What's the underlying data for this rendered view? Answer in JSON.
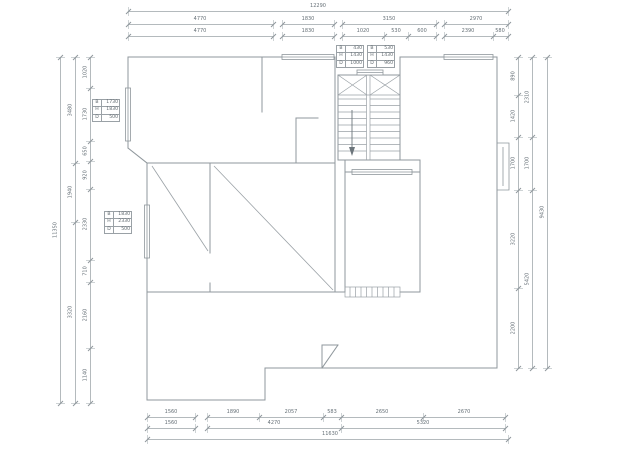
{
  "style": {
    "background": "#ffffff",
    "wall_color": "#8f979c",
    "thin_line_color": "#9aa1a6",
    "dim_line_color": "#b4babd",
    "dim_text_color": "#667077"
  },
  "dim_chains": [
    {
      "id": "top-total",
      "dir": "h",
      "pos": 11,
      "groups": [
        {
          "a": 128,
          "b": 508,
          "ticks": [
            128,
            508
          ],
          "labels": [
            {
              "v": "12290",
              "p": 318
            }
          ]
        }
      ]
    },
    {
      "id": "top-row2",
      "dir": "h",
      "pos": 24,
      "groups": [
        {
          "a": 128,
          "b": 273,
          "ticks": [
            128,
            273
          ],
          "labels": [
            {
              "v": "4770",
              "p": 200
            }
          ]
        },
        {
          "a": 282,
          "b": 334,
          "ticks": [
            282,
            334
          ],
          "labels": [
            {
              "v": "1830",
              "p": 308
            }
          ]
        },
        {
          "a": 342,
          "b": 436,
          "ticks": [
            342,
            436
          ],
          "labels": [
            {
              "v": "3150",
              "p": 389
            }
          ]
        },
        {
          "a": 444,
          "b": 508,
          "ticks": [
            444,
            508
          ],
          "labels": [
            {
              "v": "2970",
              "p": 476
            }
          ]
        }
      ]
    },
    {
      "id": "top-row3",
      "dir": "h",
      "pos": 36,
      "groups": [
        {
          "a": 128,
          "b": 273,
          "ticks": [
            128,
            273
          ],
          "labels": [
            {
              "v": "4770",
              "p": 200
            }
          ]
        },
        {
          "a": 282,
          "b": 334,
          "ticks": [
            282,
            334
          ],
          "labels": [
            {
              "v": "1830",
              "p": 308
            }
          ]
        },
        {
          "a": 342,
          "b": 436,
          "ticks": [
            342,
            384,
            408,
            436
          ],
          "labels": [
            {
              "v": "1020",
              "p": 363
            },
            {
              "v": "530",
              "p": 396
            },
            {
              "v": "600",
              "p": 422
            }
          ]
        },
        {
          "a": 444,
          "b": 508,
          "ticks": [
            444,
            493,
            508
          ],
          "labels": [
            {
              "v": "2390",
              "p": 468
            },
            {
              "v": "580",
              "p": 500
            }
          ]
        }
      ]
    },
    {
      "id": "left-total",
      "dir": "v",
      "pos": 60,
      "groups": [
        {
          "a": 57,
          "b": 403,
          "ticks": [
            57,
            403
          ],
          "labels": [
            {
              "v": "11350",
              "p": 230
            }
          ]
        }
      ]
    },
    {
      "id": "left-mid",
      "dir": "v",
      "pos": 75,
      "groups": [
        {
          "a": 57,
          "b": 403,
          "ticks": [
            57,
            163,
            222,
            403
          ],
          "labels": [
            {
              "v": "3480",
              "p": 110
            },
            {
              "v": "1940",
              "p": 192
            },
            {
              "v": "3320",
              "p": 312
            }
          ]
        }
      ]
    },
    {
      "id": "left-inner",
      "dir": "v",
      "pos": 90,
      "groups": [
        {
          "a": 57,
          "b": 403,
          "ticks": [
            57,
            88,
            141,
            161,
            189,
            260,
            282,
            348,
            403
          ],
          "labels": [
            {
              "v": "1020",
              "p": 72
            },
            {
              "v": "1730",
              "p": 114
            },
            {
              "v": "650",
              "p": 151
            },
            {
              "v": "920",
              "p": 175
            },
            {
              "v": "2330",
              "p": 224
            },
            {
              "v": "710",
              "p": 271
            },
            {
              "v": "2160",
              "p": 315
            },
            {
              "v": "1140",
              "p": 375
            }
          ]
        }
      ]
    },
    {
      "id": "right-inner",
      "dir": "v",
      "pos": 518,
      "groups": [
        {
          "a": 57,
          "b": 368,
          "ticks": [
            57,
            95,
            137,
            190,
            288,
            368
          ],
          "labels": [
            {
              "v": "890",
              "p": 76
            },
            {
              "v": "1420",
              "p": 116
            },
            {
              "v": "1700",
              "p": 163
            },
            {
              "v": "3220",
              "p": 239
            },
            {
              "v": "2200",
              "p": 328
            }
          ]
        }
      ]
    },
    {
      "id": "right-mid",
      "dir": "v",
      "pos": 532,
      "groups": [
        {
          "a": 57,
          "b": 368,
          "ticks": [
            57,
            137,
            190,
            368
          ],
          "labels": [
            {
              "v": "2310",
              "p": 97
            },
            {
              "v": "1700",
              "p": 163
            },
            {
              "v": "5420",
              "p": 279
            }
          ]
        }
      ]
    },
    {
      "id": "right-outer",
      "dir": "v",
      "pos": 547,
      "groups": [
        {
          "a": 57,
          "b": 368,
          "ticks": [
            57,
            368
          ],
          "labels": [
            {
              "v": "9430",
              "p": 212
            }
          ]
        }
      ]
    },
    {
      "id": "bottom-row1",
      "dir": "h",
      "pos": 417,
      "groups": [
        {
          "a": 147,
          "b": 195,
          "ticks": [
            147,
            195
          ],
          "labels": [
            {
              "v": "1560",
              "p": 171
            }
          ]
        },
        {
          "a": 207,
          "b": 505,
          "ticks": [
            207,
            259,
            323,
            341,
            423,
            505
          ],
          "labels": [
            {
              "v": "1890",
              "p": 233
            },
            {
              "v": "2057",
              "p": 291
            },
            {
              "v": "583",
              "p": 332
            },
            {
              "v": "2650",
              "p": 382
            },
            {
              "v": "2670",
              "p": 464
            }
          ]
        }
      ]
    },
    {
      "id": "bottom-row2",
      "dir": "h",
      "pos": 428,
      "groups": [
        {
          "a": 147,
          "b": 195,
          "ticks": [
            147,
            195
          ],
          "labels": [
            {
              "v": "1560",
              "p": 171
            }
          ]
        },
        {
          "a": 207,
          "b": 505,
          "ticks": [
            207,
            341,
            505
          ],
          "labels": [
            {
              "v": "4270",
              "p": 274
            },
            {
              "v": "5320",
              "p": 423
            }
          ]
        }
      ]
    },
    {
      "id": "bottom-row3",
      "dir": "h",
      "pos": 439,
      "groups": [
        {
          "a": 147,
          "b": 508,
          "ticks": [
            147,
            508
          ],
          "labels": [
            {
              "v": "11630",
              "p": 330
            }
          ]
        }
      ]
    }
  ],
  "window_tables": [
    {
      "x": 336,
      "y": 45,
      "rows": [
        [
          "B",
          "430"
        ],
        [
          "H",
          "1430"
        ],
        [
          "D",
          "1000"
        ]
      ]
    },
    {
      "x": 367,
      "y": 45,
      "rows": [
        [
          "B",
          "530"
        ],
        [
          "H",
          "1430"
        ],
        [
          "D",
          "960"
        ]
      ]
    },
    {
      "x": 92,
      "y": 99,
      "rows": [
        [
          "B",
          "1730"
        ],
        [
          "H",
          "1830"
        ],
        [
          "D",
          "500"
        ]
      ]
    },
    {
      "x": 104,
      "y": 211,
      "rows": [
        [
          "B",
          "1830"
        ],
        [
          "H",
          "2330"
        ],
        [
          "D",
          "500"
        ]
      ]
    }
  ]
}
